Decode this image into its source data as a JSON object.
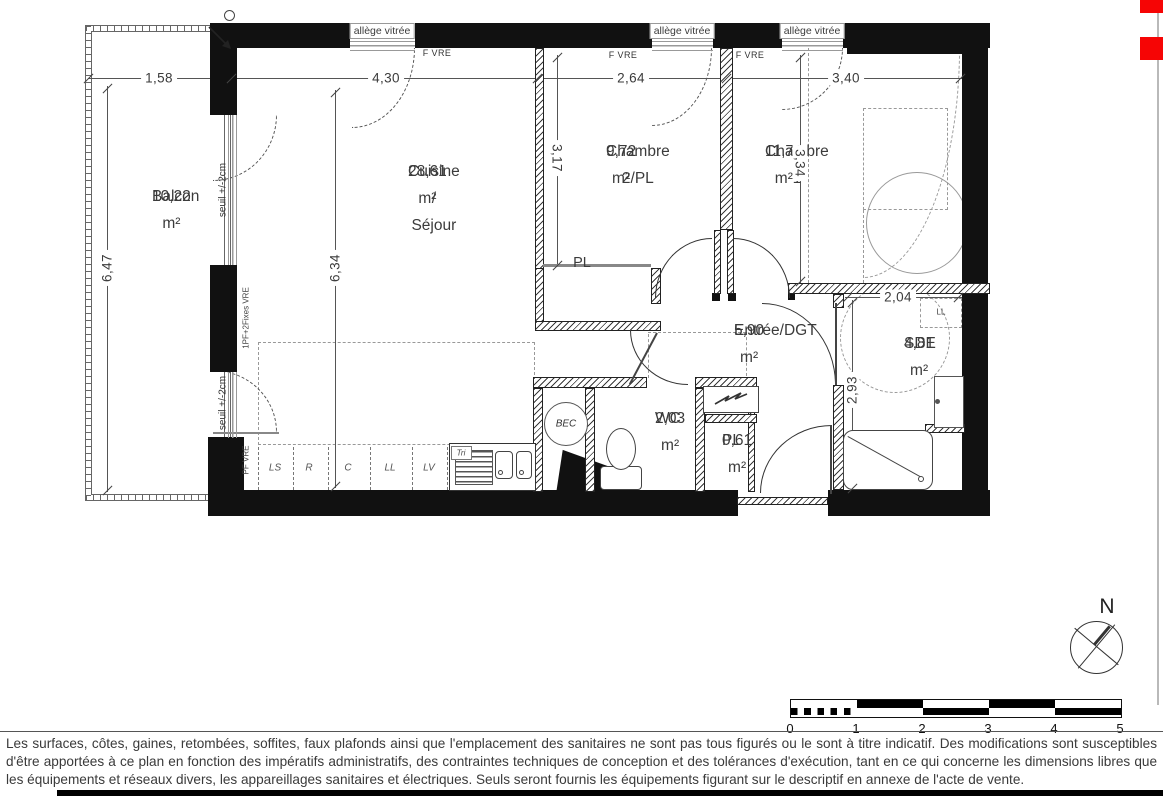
{
  "colors": {
    "accent_red": "#f60505",
    "wall": "#111111"
  },
  "rooms": [
    {
      "name": "Balcon",
      "area": "10,22 m²",
      "x": 152,
      "y": 197
    },
    {
      "name": "Cuisine / Séjour",
      "area": "28,61 m²",
      "x": 408,
      "y": 172
    },
    {
      "name": "Chambre 2/PL",
      "area": "9,72 m²",
      "x": 606,
      "y": 152
    },
    {
      "name": "Chambre 1",
      "area": "11,71 m²",
      "x": 765,
      "y": 152
    },
    {
      "name": "Entrée/DGT",
      "area": "5,90 m²",
      "x": 734,
      "y": 331
    },
    {
      "name": "WC",
      "area": "2,03 m²",
      "x": 655,
      "y": 419
    },
    {
      "name": "PL",
      "area": "0,61 m²",
      "x": 722,
      "y": 441
    },
    {
      "name": "SDE",
      "area": "4,81 m²",
      "x": 904,
      "y": 344
    }
  ],
  "dimensions": [
    {
      "label": "1,58",
      "x": 159,
      "y": 78,
      "rot": 0
    },
    {
      "label": "4,30",
      "x": 386,
      "y": 78,
      "rot": 0
    },
    {
      "label": "2,64",
      "x": 631,
      "y": 78,
      "rot": 0
    },
    {
      "label": "3,40",
      "x": 846,
      "y": 78,
      "rot": 0
    },
    {
      "label": "6,47",
      "x": 107,
      "y": 268,
      "rot": -90
    },
    {
      "label": "6,34",
      "x": 335,
      "y": 268,
      "rot": -90
    },
    {
      "label": "3,17",
      "x": 557,
      "y": 158,
      "rot": 90
    },
    {
      "label": "3,34",
      "x": 800,
      "y": 163,
      "rot": 90
    },
    {
      "label": "2,04",
      "x": 898,
      "y": 297,
      "rot": 0
    },
    {
      "label": "2,93",
      "x": 852,
      "y": 390,
      "rot": -90
    }
  ],
  "annotations": [
    {
      "text": "allège vitrée",
      "x": 382,
      "y": 31,
      "cls": "wlabel"
    },
    {
      "text": "allège vitrée",
      "x": 682,
      "y": 31,
      "cls": "wlabel"
    },
    {
      "text": "allège vitrée",
      "x": 812,
      "y": 31,
      "cls": "wlabel"
    },
    {
      "text": "F VRE",
      "x": 437,
      "y": 53,
      "cls": "tiny"
    },
    {
      "text": "F VRE",
      "x": 623,
      "y": 55,
      "cls": "tiny"
    },
    {
      "text": "F VRE",
      "x": 750,
      "y": 55,
      "cls": "tiny"
    },
    {
      "text": "seuil +/-2cm",
      "x": 223,
      "y": 190,
      "rot": -90,
      "cls": "tiny2"
    },
    {
      "text": "seuil +/-2cm",
      "x": 223,
      "y": 403,
      "rot": -90,
      "cls": "tiny2"
    },
    {
      "text": "1PF+2Fixes VRE",
      "x": 246,
      "y": 318,
      "rot": -90,
      "cls": "tiny3"
    },
    {
      "text": "PF VRE",
      "x": 246,
      "y": 460,
      "rot": -90,
      "cls": "tiny3"
    },
    {
      "text": "PL",
      "x": 582,
      "y": 263,
      "cls": "room-sub"
    },
    {
      "text": "LL",
      "x": 941,
      "y": 312,
      "cls": "tiny3"
    },
    {
      "text": "BEC",
      "x": 566,
      "y": 424,
      "cls": "tiny2 it"
    },
    {
      "text": "Tri",
      "x": 461,
      "y": 453,
      "cls": "tiny3 it"
    },
    {
      "text": "N",
      "x": 1107,
      "y": 607,
      "cls": "north"
    }
  ],
  "kitchen": {
    "units": [
      {
        "label": "LS",
        "x": 275
      },
      {
        "label": "R",
        "x": 309
      },
      {
        "label": "C",
        "x": 348
      },
      {
        "label": "LL",
        "x": 390
      },
      {
        "label": "LV",
        "x": 429
      }
    ],
    "y": 468
  },
  "scale_bar": {
    "numbers": [
      "0",
      "1",
      "2",
      "3",
      "4",
      "5"
    ],
    "x0": 790,
    "unit": 66,
    "num_y": 728
  },
  "compass": {
    "label": "N"
  },
  "disclaimer": "Les surfaces, côtes, gaines, retombées, soffites, faux plafonds ainsi que l'emplacement des sanitaires ne sont pas tous figurés ou le sont à titre indicatif. Des modifications sont susceptibles d'être apportées à ce plan en fonction des impératifs administratifs, des contraintes techniques de conception et des tolérances d'exécution, tant en ce qui concerne les dimensions libres que les équipements et réseaux divers, les appareillages sanitaires et électriques. Seuls seront fournis les équipements figurant sur le descriptif en annexe de l'acte de vente."
}
